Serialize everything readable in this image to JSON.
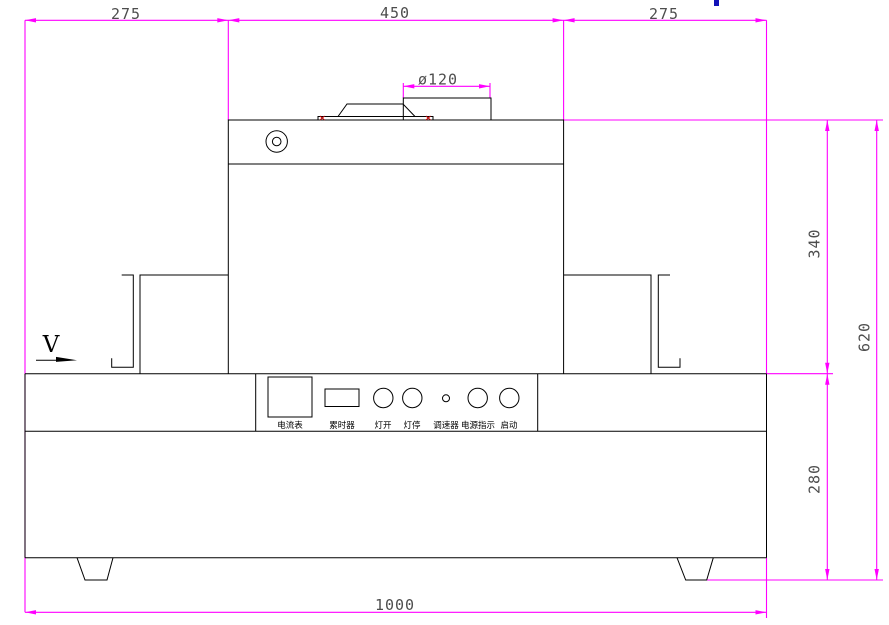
{
  "drawing": {
    "view_label": "V",
    "dimensions": {
      "top_left_width": "275",
      "top_center_width": "450",
      "top_right_width": "275",
      "vent_diameter": "ø120",
      "upper_height": "340",
      "total_height": "620",
      "base_height": "280",
      "total_width": "1000"
    },
    "control_panel": {
      "ammeter": "电流表",
      "timer": "累时器",
      "lamp_on": "灯开",
      "lamp_off": "灯停",
      "speed_regulator": "调速器",
      "power_indicator": "电源指示",
      "start": "启动"
    },
    "colors": {
      "outline": "#000000",
      "dimension_line": "#ff00ff",
      "dimension_text": "#4d4d4d",
      "marker_red": "#c00000",
      "corner_blue": "#1212b8",
      "background": "#ffffff"
    }
  }
}
